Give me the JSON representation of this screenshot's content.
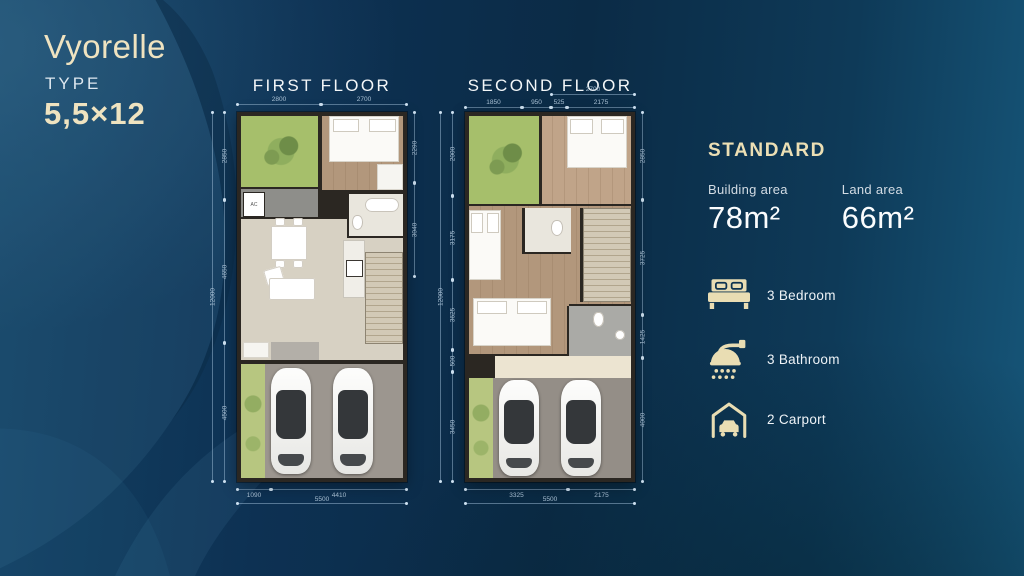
{
  "brand": {
    "logo": "Vyorelle",
    "type_label": "TYPE",
    "type_value": "5,5×12"
  },
  "plans": {
    "first": {
      "title": "FIRST FLOOR",
      "ac_label": "AC",
      "dims": {
        "top": [
          "2800",
          "2700"
        ],
        "right": [
          "2290",
          "3040"
        ],
        "left": [
          "2850",
          "4650",
          "4500"
        ],
        "left_total": "12000",
        "bottom": [
          "1090",
          "4410"
        ],
        "bottom_total": "5500"
      }
    },
    "second": {
      "title": "SECOND FLOOR",
      "dims": {
        "top_overall": "2700",
        "top": [
          "1850",
          "950",
          "525",
          "2175"
        ],
        "right": [
          "2850",
          "3725",
          "1425",
          "4000"
        ],
        "left": [
          "2000",
          "3175",
          "3625",
          "500",
          "3450"
        ],
        "left_total": "12000",
        "bottom": [
          "3325",
          "2175"
        ],
        "bottom_total": "5500"
      }
    }
  },
  "specs": {
    "heading": "STANDARD",
    "building_area": {
      "label": "Building area",
      "value": "78m²"
    },
    "land_area": {
      "label": "Land area",
      "value": "66m²"
    },
    "amenities": [
      {
        "icon": "bed-icon",
        "label": "3 Bedroom"
      },
      {
        "icon": "shower-icon",
        "label": "3 Bathroom"
      },
      {
        "icon": "carport-icon",
        "label": "2 Carport"
      }
    ]
  },
  "colors": {
    "accent_cream": "#ecdfb4",
    "background_navy": "#0b2b46",
    "text_white": "#f3f6f8"
  }
}
